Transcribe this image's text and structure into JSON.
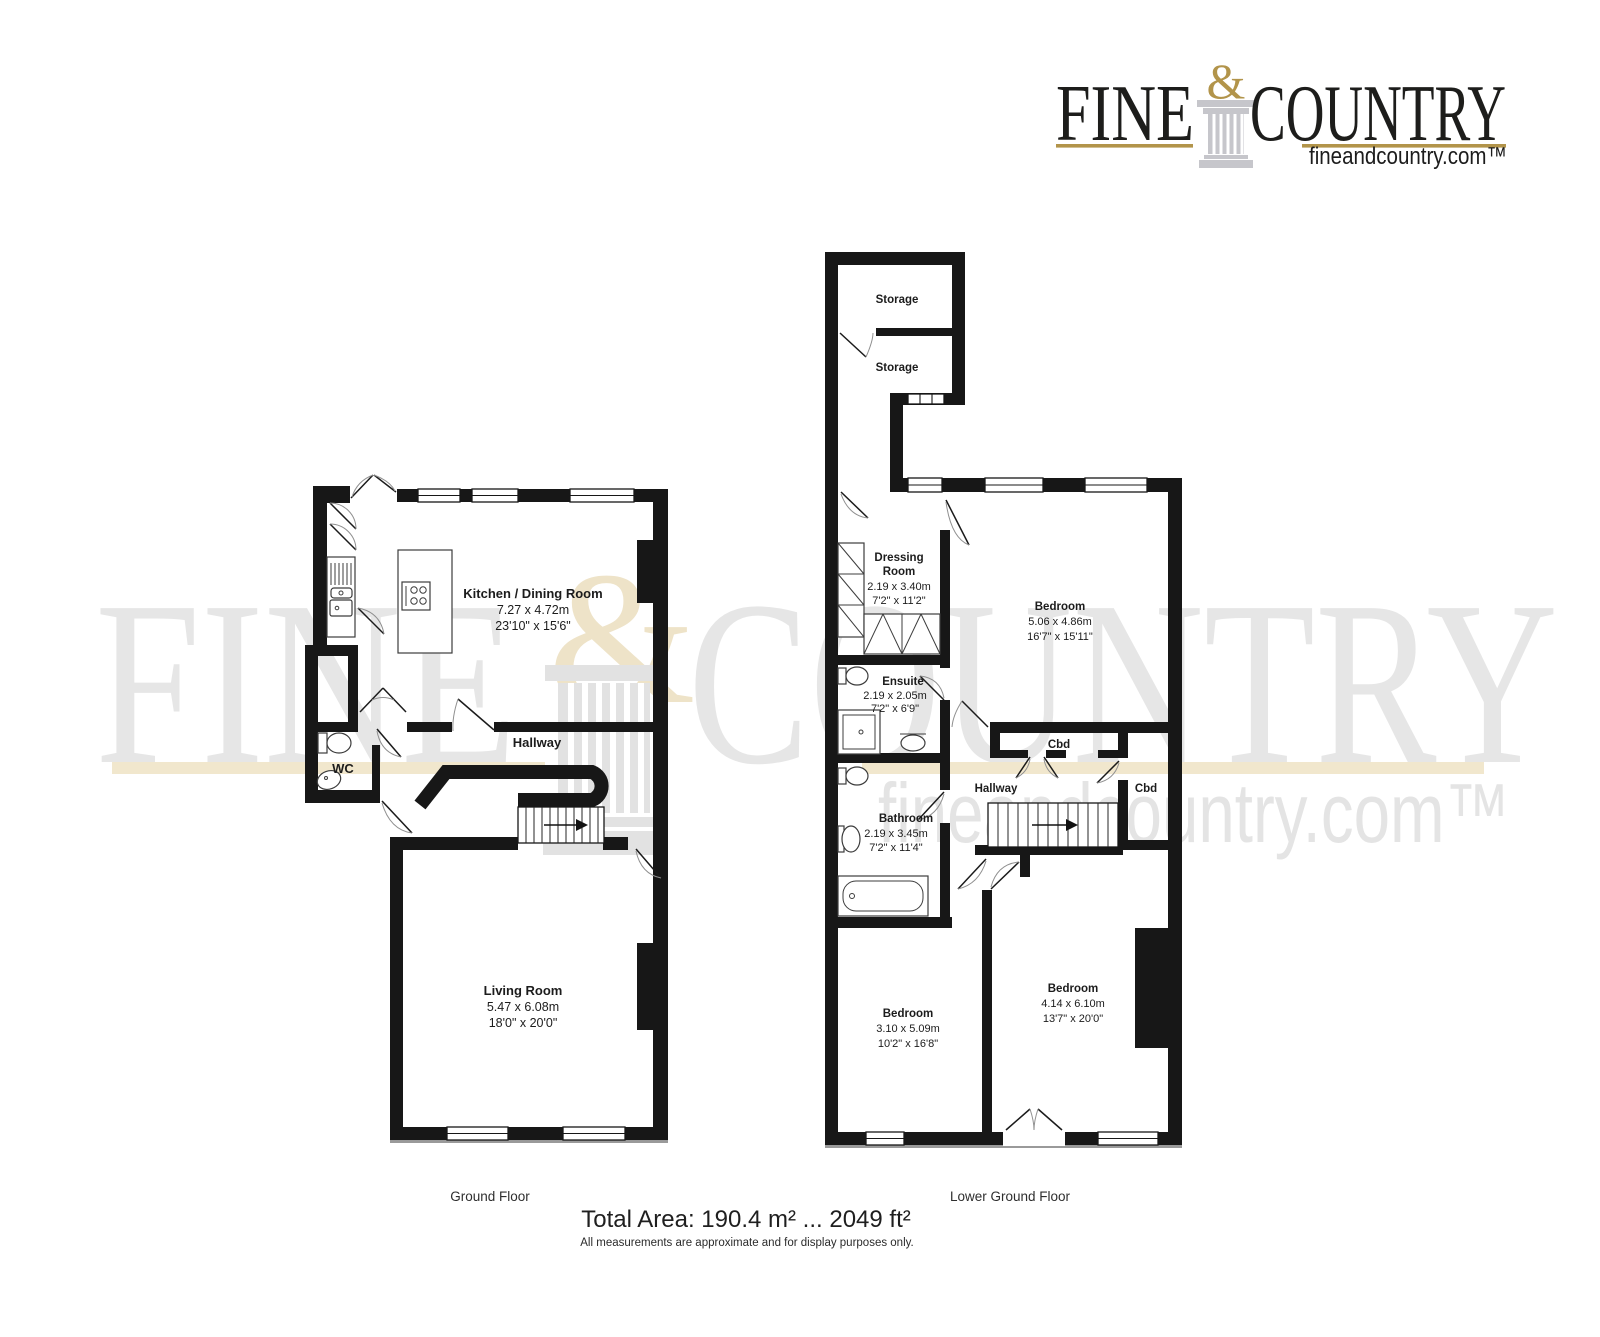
{
  "logo": {
    "word_left": "FINE",
    "ampersand": "&",
    "word_right": "COUNTRY",
    "website": "fineandcountry.com™"
  },
  "watermark": {
    "word_left": "FINE",
    "ampersand": "&",
    "word_right": "COUNTRY",
    "website": "fineandcountry.com™"
  },
  "ground_floor": {
    "title": "Ground Floor",
    "kitchen": {
      "name": "Kitchen / Dining Room",
      "metric": "7.27 x 4.72m",
      "imperial": "23'10\" x 15'6\""
    },
    "hallway": {
      "name": "Hallway"
    },
    "wc": {
      "name": "WC"
    },
    "living": {
      "name": "Living Room",
      "metric": "5.47 x 6.08m",
      "imperial": "18'0\" x 20'0\""
    }
  },
  "lower_ground_floor": {
    "title": "Lower Ground Floor",
    "storage1": {
      "name": "Storage"
    },
    "storage2": {
      "name": "Storage"
    },
    "dressing": {
      "name_line1": "Dressing",
      "name_line2": "Room",
      "metric": "2.19 x 3.40m",
      "imperial": "7'2\" x 11'2\""
    },
    "bedroom1": {
      "name": "Bedroom",
      "metric": "5.06 x 4.86m",
      "imperial": "16'7\" x 15'11\""
    },
    "ensuite": {
      "name": "Ensuite",
      "metric": "2.19 x 2.05m",
      "imperial": "7'2\" x 6'9\""
    },
    "cbd1": {
      "name": "Cbd"
    },
    "cbd2": {
      "name": "Cbd"
    },
    "hallway": {
      "name": "Hallway"
    },
    "bathroom": {
      "name": "Bathroom",
      "metric": "2.19 x 3.45m",
      "imperial": "7'2\" x 11'4\""
    },
    "bedroom2": {
      "name": "Bedroom",
      "metric": "3.10 x 5.09m",
      "imperial": "10'2\" x 16'8\""
    },
    "bedroom3": {
      "name": "Bedroom",
      "metric": "4.14 x 6.10m",
      "imperial": "13'7\" x 20'0\""
    }
  },
  "footer": {
    "total_area": "Total Area: 190.4 m² ... 2049 ft²",
    "disclaimer": "All measurements are approximate and for display purposes only."
  },
  "colors": {
    "wall": "#171717",
    "gold": "#b2944a",
    "watermark_gray": "#e6e6e6",
    "watermark_tan": "#f1e7cd"
  }
}
